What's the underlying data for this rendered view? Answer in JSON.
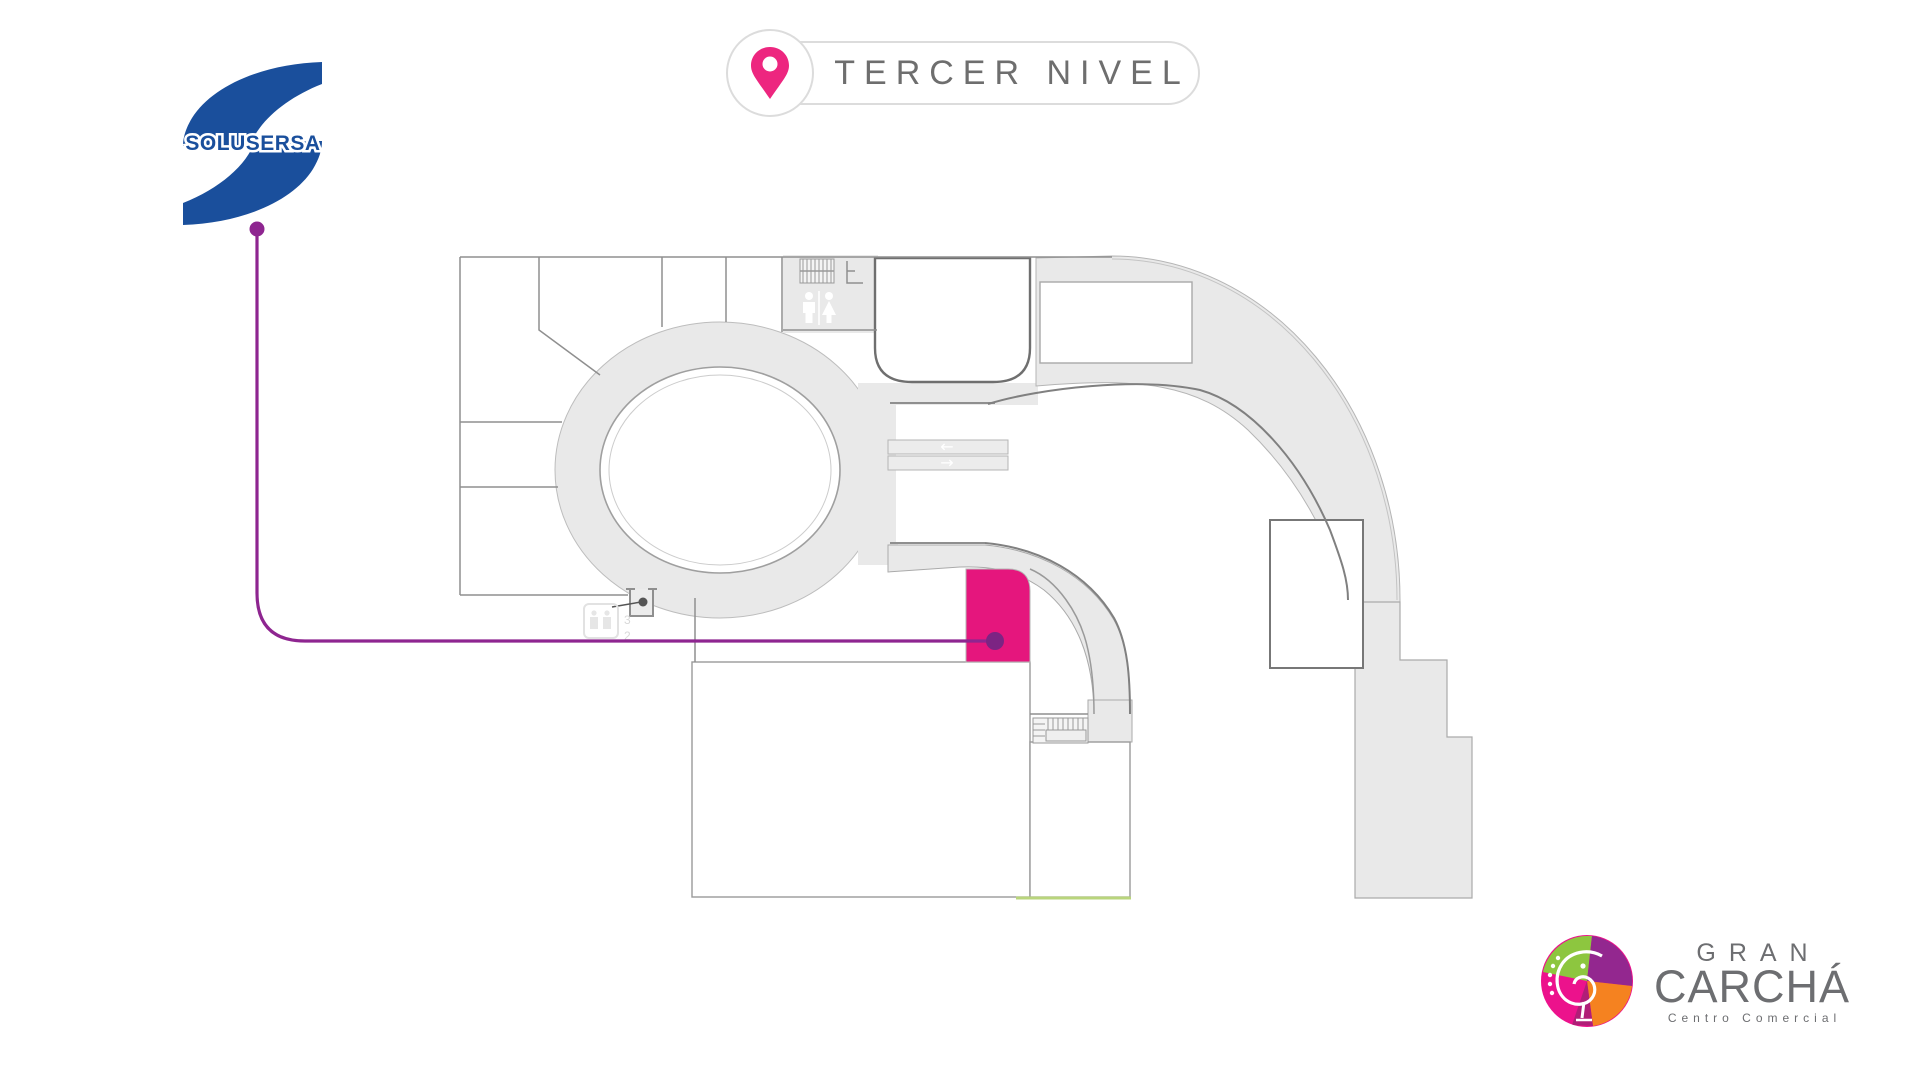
{
  "badge": {
    "label": "TERCER NIVEL"
  },
  "brand": {
    "name": "SOLUSERSA"
  },
  "mall": {
    "name_top": "GRAN",
    "name_main": "CARCHÁ",
    "tagline": "Centro Comercial"
  },
  "floorplan": {
    "level_shown": "3",
    "elevator_levels": {
      "current": "3",
      "other": "2"
    },
    "escalator": {
      "up_glyph": "←",
      "down_glyph": "→"
    },
    "colors": {
      "corridor": "#e9e9e9",
      "wall": "#8f8f8f",
      "highlight_pink": "#e5167d",
      "leader_purple": "#8e2590",
      "pin_pink": "#ed267f",
      "brand_blue": "#1a4f9c",
      "accent_green": "#b9d57c",
      "logo_green": "#8dc63f",
      "logo_purple": "#93278f",
      "logo_pink": "#ec128c",
      "logo_orange": "#f58220"
    }
  }
}
